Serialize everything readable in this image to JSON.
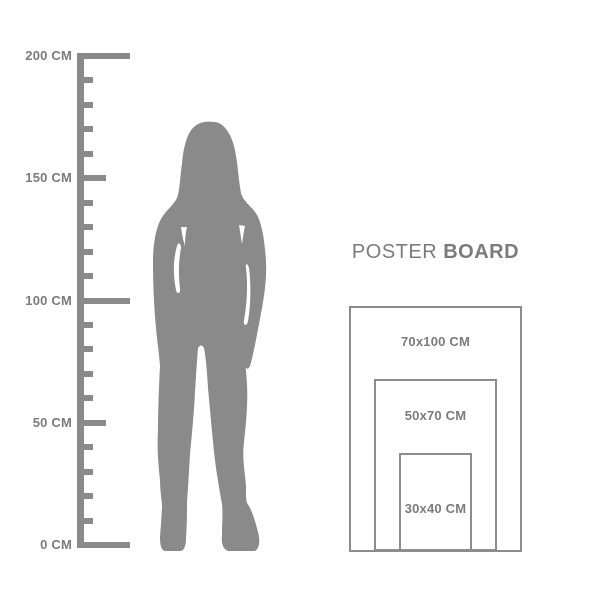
{
  "colors": {
    "background": "#ffffff",
    "shape_gray": "#8a8a8a",
    "line_gray": "#8c8c8c",
    "text_gray": "#7b7b7b"
  },
  "ruler": {
    "unit": "CM",
    "min_cm": 0,
    "max_cm": 200,
    "minor_step_cm": 10,
    "mid_step_cm": 50,
    "major_step_cm": 100,
    "labels": [
      {
        "cm": 200,
        "text": "200 CM"
      },
      {
        "cm": 150,
        "text": "150 CM"
      },
      {
        "cm": 100,
        "text": "100 CM"
      },
      {
        "cm": 50,
        "text": "50 CM"
      },
      {
        "cm": 0,
        "text": "0 CM"
      }
    ]
  },
  "figure": {
    "kind": "woman-silhouette-standing"
  },
  "poster_board": {
    "title": {
      "regular": "POSTER",
      "bold": "BOARD"
    },
    "sizes": [
      {
        "label": "70x100 CM",
        "width_cm": 70,
        "height_cm": 100
      },
      {
        "label": "50x70 CM",
        "width_cm": 50,
        "height_cm": 70
      },
      {
        "label": "30x40 CM",
        "width_cm": 30,
        "height_cm": 40
      }
    ]
  }
}
